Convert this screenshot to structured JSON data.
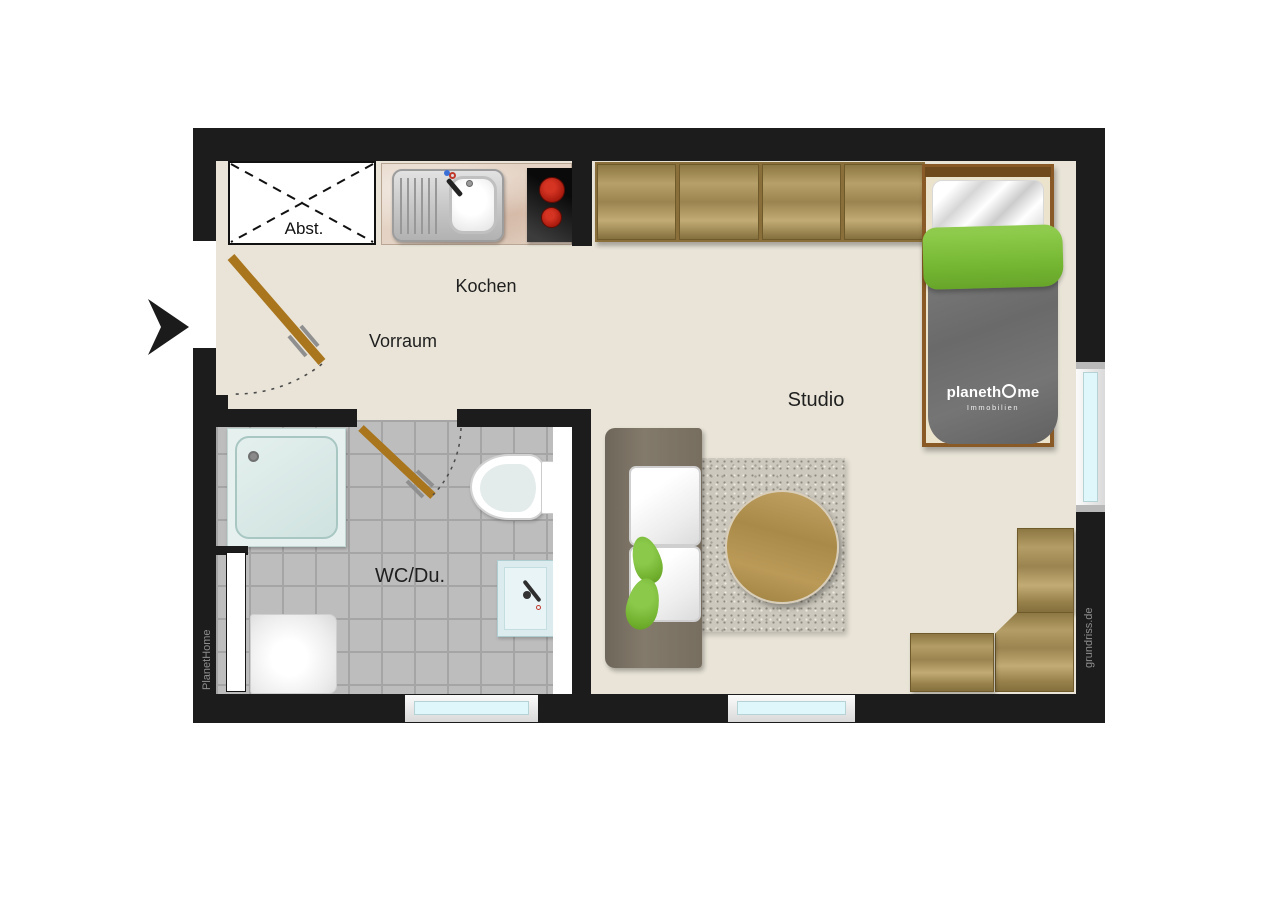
{
  "floorplan": {
    "labels": {
      "storage": "Abst.",
      "kitchen": "Kochen",
      "hall": "Vorraum",
      "studio": "Studio",
      "bath": "WC/Du."
    },
    "watermarks": {
      "left": "PlanetHome",
      "right": "grundriss.de"
    },
    "bed_logo": {
      "full": "planethOme",
      "part1": "planeth",
      "part2": "me",
      "subtitle": "Immobilien"
    },
    "colors": {
      "wall": "#1c1c1c",
      "floor": "#e9e4d7",
      "tile": "#bdbdbd",
      "wood": "#ab9259",
      "door": "#a9751d",
      "accent_green": "#76b833",
      "blanket_gray": "#6f6f6f",
      "window_glass": "#dff7fa",
      "burner_red": "#b92012"
    }
  }
}
